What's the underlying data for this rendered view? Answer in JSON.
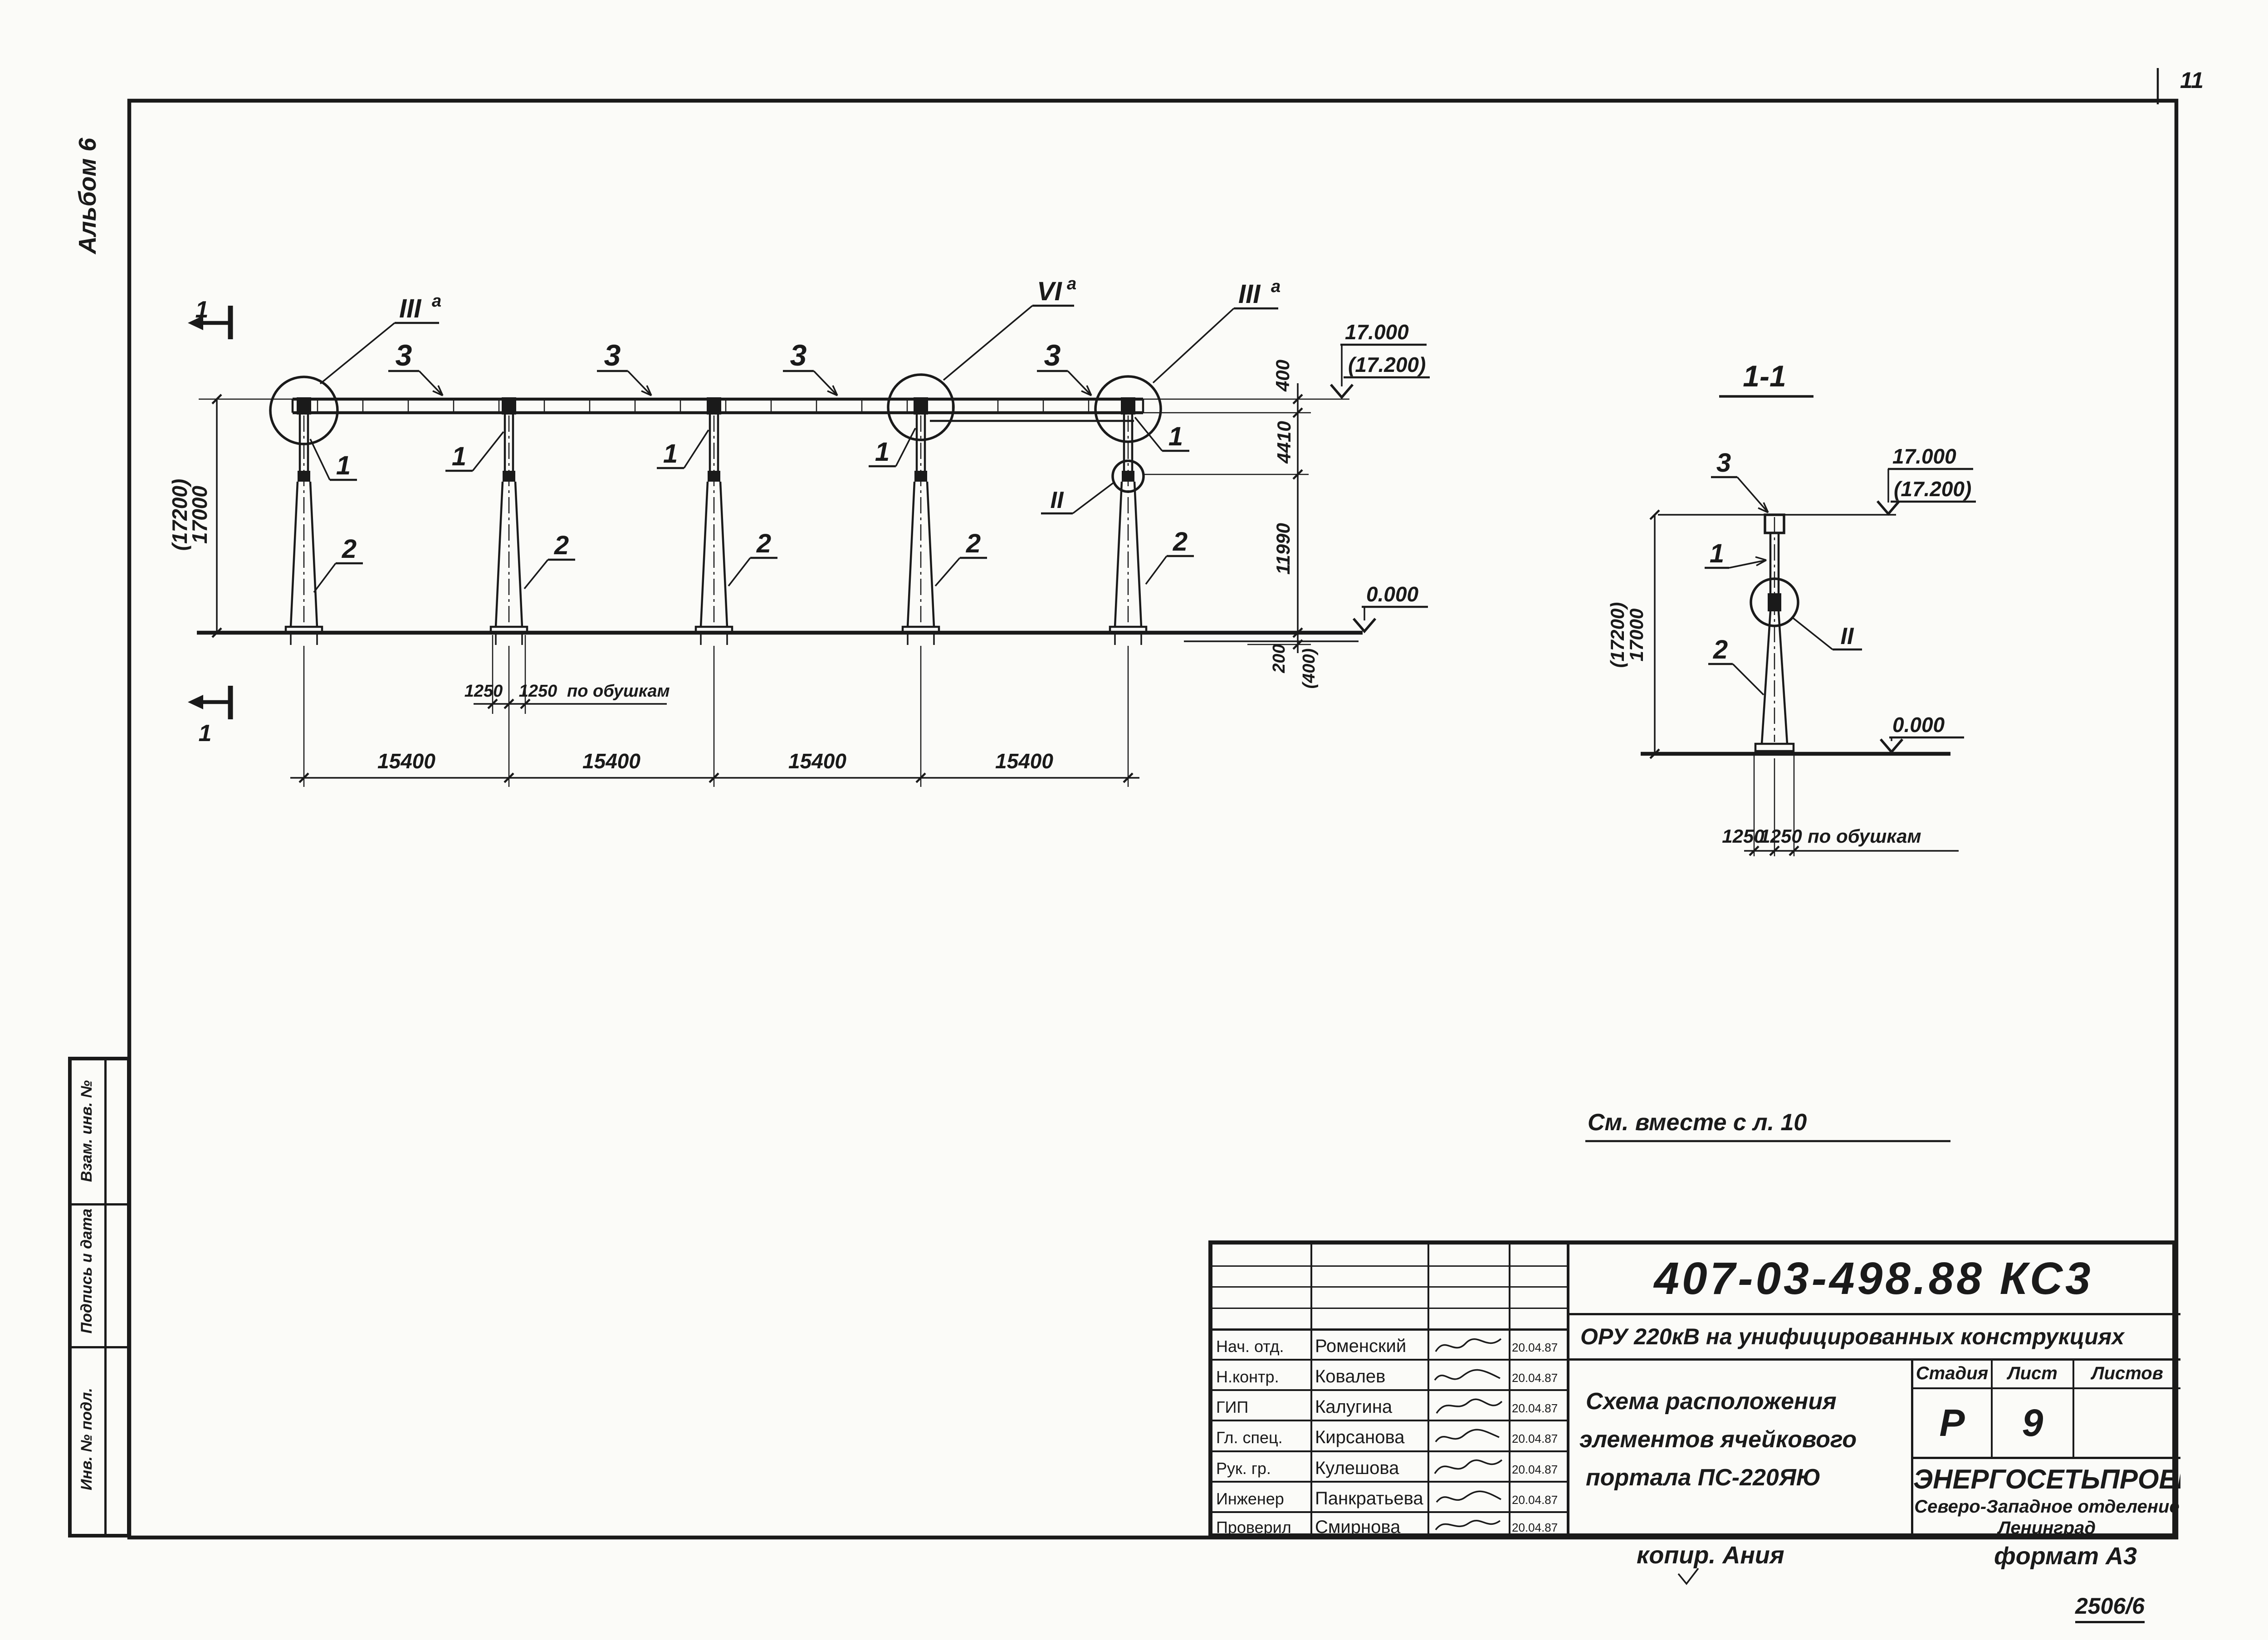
{
  "sheet": {
    "page_number": "11",
    "album_note": "Альбом 6",
    "see_also_note": "См. вместе с л. 10",
    "copy_note": "копир. Ания",
    "format_note": "формат А3",
    "archive_number": "2506/6"
  },
  "side_stamp": {
    "cell_top": "Взам. инв. №",
    "cell_middle": "Подпись и дата",
    "cell_bottom": "Инв. № подл."
  },
  "drawing": {
    "section_title": "1-1",
    "section_mark_digit": "1",
    "part_beam": "3",
    "part_top": "1",
    "part_column": "2",
    "callout_node3": {
      "base": "III",
      "sup": "а"
    },
    "callout_node6": {
      "base": "VI",
      "sup": "а"
    },
    "callout_joint": "II",
    "levels": {
      "top": "17.000",
      "top_alt": "(17.200)",
      "zero": "0.000"
    },
    "dims": {
      "total_height": "17000",
      "total_height_alt": "(17200)",
      "beam_depth": "400",
      "top_part_len": "4410",
      "column_len": "11990",
      "embed": "200",
      "embed_alt": "(400)",
      "bay": "15400",
      "base_chord": "1250",
      "base_note": "по обушкам"
    }
  },
  "title_block": {
    "doc_number": "407-03-498.88 КС3",
    "object_title": "ОРУ 220кВ на унифицированных конструкциях",
    "sheet_title_line1": "Схема расположения",
    "sheet_title_line2": "элементов ячейкового",
    "sheet_title_line3": "портала ПС-220ЯЮ",
    "stage_label": "Стадия",
    "sheet_label": "Лист",
    "sheets_label": "Листов",
    "stage_value": "Р",
    "sheet_value": "9",
    "sheets_value": "",
    "org_name": "ЭНЕРГОСЕТЬПРОЕКТ",
    "org_branch": "Северо-Западное отделение",
    "org_city": "Ленинград",
    "rows": [
      {
        "role": "Нач. отд.",
        "name": "Роменский",
        "date": "20.04.87"
      },
      {
        "role": "Н.контр.",
        "name": "Ковалев",
        "date": "20.04.87"
      },
      {
        "role": "ГИП",
        "name": "Калугина",
        "date": "20.04.87"
      },
      {
        "role": "Гл. спец.",
        "name": "Кирсанова",
        "date": "20.04.87"
      },
      {
        "role": "Рук. гр.",
        "name": "Кулешова",
        "date": "20.04.87"
      },
      {
        "role": "Инженер",
        "name": "Панкратьева",
        "date": "20.04.87"
      },
      {
        "role": "Проверил",
        "name": "Смирнова",
        "date": "20.04.87"
      }
    ]
  }
}
